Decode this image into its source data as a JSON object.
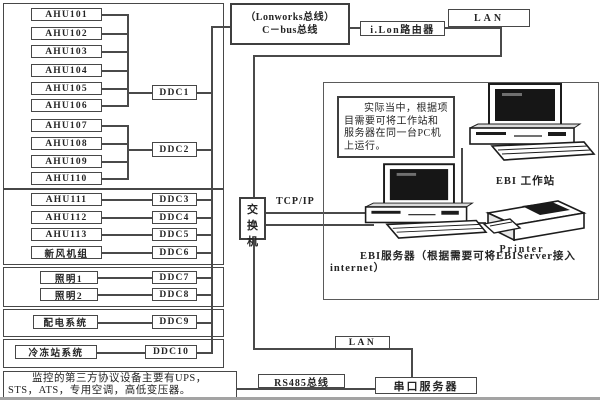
{
  "left_panel": {
    "group1": {
      "devices": [
        "AHU101",
        "AHU102",
        "AHU103",
        "AHU104",
        "AHU105",
        "AHU106",
        "AHU107",
        "AHU108",
        "AHU109",
        "AHU110"
      ],
      "controllers": [
        "DDC1",
        "DDC2"
      ]
    },
    "group2": {
      "devices": [
        "AHU111",
        "AHU112",
        "AHU113",
        "新风机组"
      ],
      "controllers": [
        "DDC3",
        "DDC4",
        "DDC5",
        "DDC6"
      ]
    },
    "group3": {
      "devices": [
        "照明1",
        "照明2"
      ],
      "controllers": [
        "DDC7",
        "DDC8"
      ]
    },
    "group4": {
      "devices": [
        "配电系统"
      ],
      "controllers": [
        "DDC9"
      ]
    },
    "group5": {
      "devices": [
        "冷冻站系统"
      ],
      "controllers": [
        "DDC10"
      ]
    },
    "third_party_note": "监控的第三方协议设备主要有UPS，STS，ATS，专用空调，高低变压器。"
  },
  "network": {
    "bus_label_line1": "（Lonworks总线）",
    "bus_label_line2": "C－bus总线",
    "ilon_router": "i.Lon路由器",
    "lan_top": "LAN",
    "lan_bottom": "LAN",
    "tcp_ip": "TCP/IP",
    "switch_char_1": "交",
    "switch_char_2": "换",
    "switch_char_3": "机",
    "rs485_bus": "RS485总线",
    "serial_server": "串口服务器"
  },
  "ebi_area": {
    "note": "实际当中，根据项目需要可将工作站和服务器在同一台PC机上运行。",
    "workstation_label": "EBI 工作站",
    "server_caption": "EBI服务器（根据需要可将EBIServer接入internet）",
    "printer_label": "Printer"
  },
  "colors": {
    "line": "#4a4a4a",
    "text": "#242424",
    "background": "#ffffff"
  }
}
